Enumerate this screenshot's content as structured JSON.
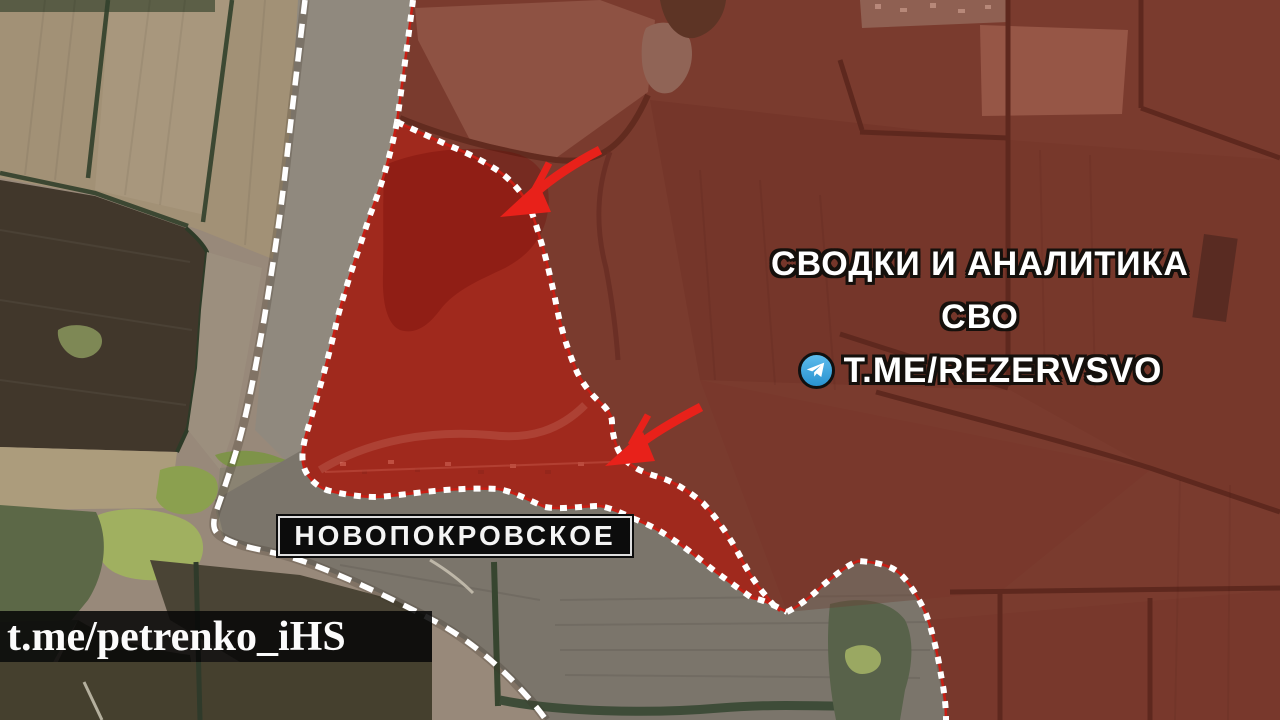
{
  "map": {
    "region_label": "НОВОПОКРОВСКОЕ",
    "watermark": "t.me/petrenko_iHS",
    "channel_overlay": {
      "line1": "СВОДКИ И АНАЛИТИКА",
      "line2": "СВО",
      "handle": "T.ME/REZERVSVO"
    },
    "annotations": {
      "attack_arrows": [
        {
          "direction": "southwest",
          "tip_x": 505,
          "tip_y": 215
        },
        {
          "direction": "southwest",
          "tip_x": 607,
          "tip_y": 463
        }
      ],
      "lines": {
        "front_line_style": "white long dashes",
        "advance_boundary_style": "white dots over red line"
      }
    },
    "colors": {
      "arrow_red": "#e8211a",
      "captured_overlay": "#c6180c",
      "controlled_overlay": "#961c12",
      "boundary_line": "#ffffff",
      "boundary_underline": "#c81e14",
      "telegram_blue": "#38a5e0",
      "label_background": "#0c0c0c",
      "label_text": "#ffffff"
    }
  }
}
